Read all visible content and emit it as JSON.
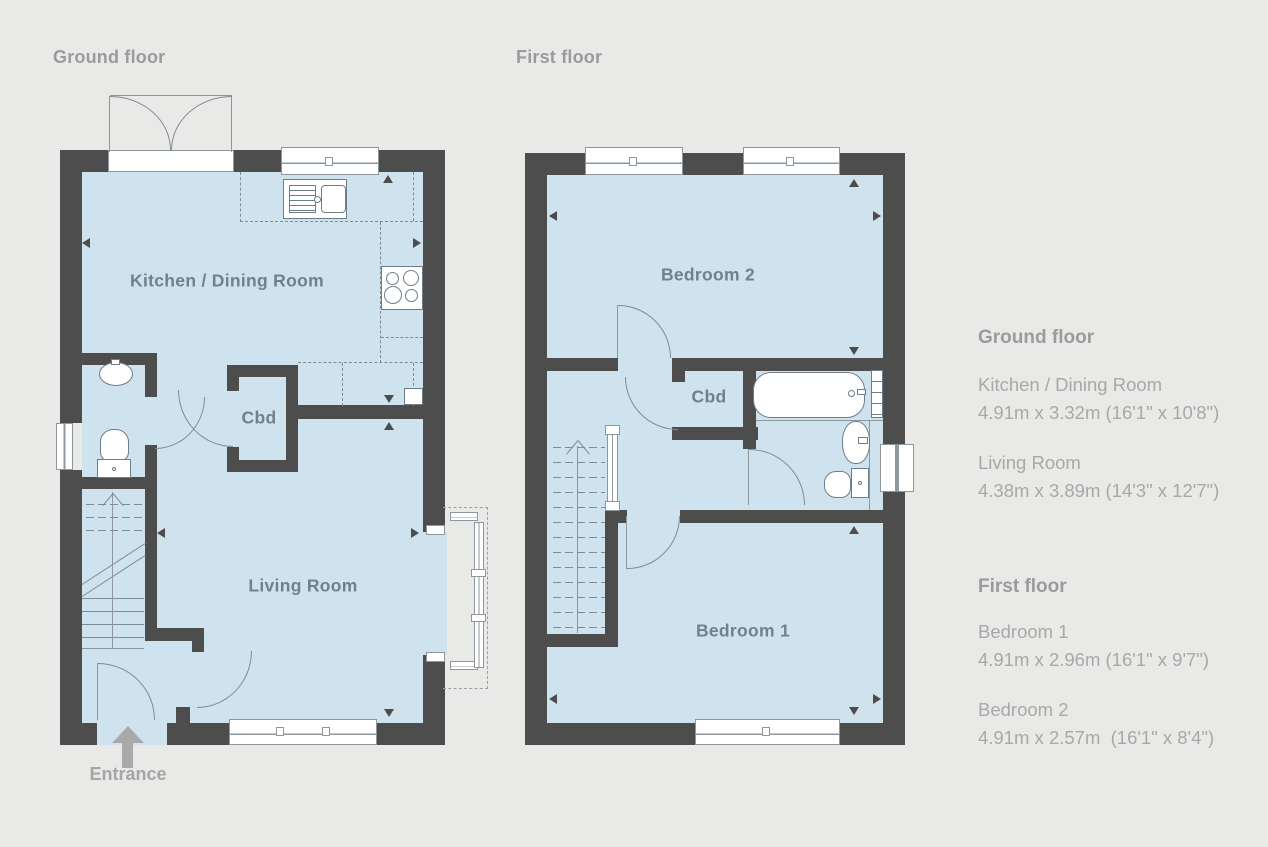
{
  "page": {
    "background": "#e9e9e7"
  },
  "colors": {
    "wall": "#4d4d4d",
    "floor_fill": "#cfe3ef",
    "plan_line": "#7e8c96",
    "room_label": "#71808b",
    "heading_text": "#9b9b9b",
    "body_text": "#a8a8a8",
    "entrance_arrow": "#a9a9a9"
  },
  "ground_floor": {
    "title": "Ground floor",
    "rooms": {
      "kitchen": "Kitchen / Dining Room",
      "cbd": "Cbd",
      "living": "Living Room"
    },
    "entrance_label": "Entrance"
  },
  "first_floor": {
    "title": "First floor",
    "rooms": {
      "bedroom2": "Bedroom 2",
      "cbd": "Cbd",
      "bedroom1": "Bedroom 1"
    }
  },
  "details_panel": {
    "ground": {
      "heading": "Ground floor",
      "items": [
        {
          "name": "Kitchen / Dining Room",
          "dims": "4.91m x 3.32m (16'1\" x 10'8\")"
        },
        {
          "name": "Living Room",
          "dims": "4.38m x 3.89m (14'3\" x 12'7\")"
        }
      ]
    },
    "first": {
      "heading": "First floor",
      "items": [
        {
          "name": "Bedroom 1",
          "dims": "4.91m x 2.96m (16'1\" x 9'7\")"
        },
        {
          "name": "Bedroom 2",
          "dims": "4.91m x 2.57m  (16'1\" x 8'4\")"
        }
      ]
    }
  }
}
